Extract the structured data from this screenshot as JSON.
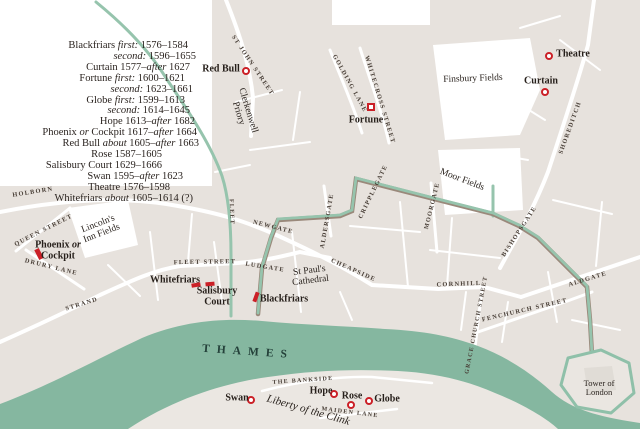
{
  "colors": {
    "building": "#e7e2dd",
    "south_bank": "#ebe7e2",
    "river_green": "#85b7a0",
    "wall_green": "#96c4ad",
    "wall_brown": "#9a897b",
    "marker_red": "#cb2027",
    "text_dark": "#2b2420"
  },
  "legend": {
    "lines": [
      {
        "pad": 12,
        "segments": [
          {
            "t": "Blackfriars "
          },
          {
            "t": "first:",
            "i": true
          },
          {
            "t": " 1576–1584"
          }
        ]
      },
      {
        "pad": 4,
        "segments": [
          {
            "t": "second:",
            "i": true
          },
          {
            "t": " 1596–1655"
          }
        ]
      },
      {
        "pad": 10,
        "segments": [
          {
            "t": "Curtain 1577–"
          },
          {
            "t": "after",
            "i": true
          },
          {
            "t": " 1627"
          }
        ]
      },
      {
        "pad": 15,
        "segments": [
          {
            "t": "Fortune "
          },
          {
            "t": "first:",
            "i": true
          },
          {
            "t": " 1600–1621"
          }
        ]
      },
      {
        "pad": 7,
        "segments": [
          {
            "t": "second:",
            "i": true
          },
          {
            "t": " 1623–1661"
          }
        ]
      },
      {
        "pad": 15,
        "segments": [
          {
            "t": "Globe "
          },
          {
            "t": "first:",
            "i": true
          },
          {
            "t": " 1599–1613"
          }
        ]
      },
      {
        "pad": 10,
        "segments": [
          {
            "t": "second:",
            "i": true
          },
          {
            "t": " 1614–1645"
          }
        ]
      },
      {
        "pad": 5,
        "segments": [
          {
            "t": "Hope 1613–"
          },
          {
            "t": "after",
            "i": true
          },
          {
            "t": " 1682"
          }
        ]
      },
      {
        "pad": 3,
        "segments": [
          {
            "t": "Phoenix "
          },
          {
            "t": "or",
            "i": true
          },
          {
            "t": " Cockpit 1617–"
          },
          {
            "t": "after",
            "i": true
          },
          {
            "t": " 1664"
          }
        ]
      },
      {
        "pad": 1,
        "segments": [
          {
            "t": "Red Bull "
          },
          {
            "t": "about",
            "i": true
          },
          {
            "t": " 1605–"
          },
          {
            "t": "after",
            "i": true
          },
          {
            "t": " 1663"
          }
        ]
      },
      {
        "pad": 38,
        "segments": [
          {
            "t": "Rose 1587–1605"
          }
        ]
      },
      {
        "pad": 38,
        "segments": [
          {
            "t": "Salisbury Court 1629–1666"
          }
        ]
      },
      {
        "pad": 17,
        "segments": [
          {
            "t": "Swan 1595–"
          },
          {
            "t": "after",
            "i": true
          },
          {
            "t": " 1623"
          }
        ]
      },
      {
        "pad": 30,
        "segments": [
          {
            "t": "Theatre 1576–1598"
          }
        ]
      },
      {
        "pad": 7,
        "segments": [
          {
            "t": "Whitefriars "
          },
          {
            "t": "about",
            "i": true
          },
          {
            "t": " 1605–1614 (?)"
          }
        ]
      }
    ]
  },
  "map": {
    "streets": [
      {
        "t": "HOLBORN",
        "x": 33,
        "y": 193,
        "r": -9
      },
      {
        "t": "QUEEN STREET",
        "x": 44,
        "y": 231,
        "r": -27
      },
      {
        "t": "DRURY LANE",
        "x": 51,
        "y": 268,
        "r": 14
      },
      {
        "t": "STRAND",
        "x": 82,
        "y": 305,
        "r": -17
      },
      {
        "t": "FLEET STREET",
        "x": 205,
        "y": 263,
        "r": -1
      },
      {
        "t": "LUDGATE",
        "x": 265,
        "y": 268,
        "r": 9
      },
      {
        "t": "NEWGATE",
        "x": 273,
        "y": 228,
        "r": 14
      },
      {
        "t": "CHEAPSIDE",
        "x": 353,
        "y": 271,
        "r": 24
      },
      {
        "t": "CORNHILL",
        "x": 459,
        "y": 285,
        "r": -2
      },
      {
        "t": "FENCHURCH STREET",
        "x": 525,
        "y": 311,
        "r": -13
      },
      {
        "t": "GRACE CHURCH STREET",
        "x": 477,
        "y": 325,
        "r": -79,
        "s": 6
      },
      {
        "t": "ALDGATE",
        "x": 588,
        "y": 280,
        "r": -17
      },
      {
        "t": "BISHOPSGATE",
        "x": 520,
        "y": 232,
        "r": -57
      },
      {
        "t": "MOORGATE",
        "x": 433,
        "y": 206,
        "r": -76
      },
      {
        "t": "CRIPPLEGATE",
        "x": 374,
        "y": 192,
        "r": -64
      },
      {
        "t": "ALDERSGATE",
        "x": 328,
        "y": 221,
        "r": -80
      },
      {
        "t": "ST JOHN STREET",
        "x": 252,
        "y": 66,
        "r": 56
      },
      {
        "t": "GOLDING LANE",
        "x": 349,
        "y": 84,
        "r": 61
      },
      {
        "t": "WHITECROSS STREET",
        "x": 379,
        "y": 100,
        "r": 73
      },
      {
        "t": "SHOREDITCH",
        "x": 571,
        "y": 128,
        "r": -70
      },
      {
        "t": "MAIDEN LANE",
        "x": 350,
        "y": 413,
        "r": 7,
        "s": 6
      },
      {
        "t": "THE BANKSIDE",
        "x": 303,
        "y": 381,
        "r": -4,
        "s": 6
      },
      {
        "t": "FLEET",
        "x": 231,
        "y": 212,
        "r": 88,
        "s": 6
      }
    ],
    "places": [
      {
        "lines": [
          "Clerkenwell",
          "Priory"
        ],
        "x": 243,
        "y": 112,
        "r": 73
      },
      {
        "lines": [
          "Finsbury Fields"
        ],
        "x": 473,
        "y": 79,
        "r": -2
      },
      {
        "lines": [
          "Moor Fields"
        ],
        "x": 462,
        "y": 180,
        "r": 21
      },
      {
        "lines": [
          "Lincoln's",
          "Inn Fields"
        ],
        "x": 100,
        "y": 229,
        "r": -21
      },
      {
        "lines": [
          "St Paul's",
          "Cathedral"
        ],
        "x": 310,
        "y": 276,
        "r": -7
      },
      {
        "lines": [
          "Liberty of the Clink"
        ],
        "x": 308,
        "y": 411,
        "r": 16,
        "italic": true,
        "s": 11
      },
      {
        "lines": [
          "Tower of",
          "London"
        ],
        "x": 599,
        "y": 388,
        "r": 0,
        "s": 8.5
      },
      {
        "lines": [
          "THAMES"
        ],
        "x": 248,
        "y": 352,
        "r": 4,
        "cls": "thames"
      }
    ],
    "theatres": [
      {
        "name": "Theatre",
        "marker": {
          "type": "circle",
          "x": 549,
          "y": 56
        },
        "label": {
          "x": 573,
          "y": 55,
          "lines": [
            [
              {
                "t": "Theatre"
              }
            ]
          ]
        }
      },
      {
        "name": "Curtain",
        "marker": {
          "type": "circle",
          "x": 545,
          "y": 92
        },
        "label": {
          "x": 541,
          "y": 82,
          "lines": [
            [
              {
                "t": "Curtain"
              }
            ]
          ]
        }
      },
      {
        "name": "Red Bull",
        "marker": {
          "type": "circle",
          "x": 246,
          "y": 71
        },
        "label": {
          "x": 221,
          "y": 70,
          "lines": [
            [
              {
                "t": "Red Bull"
              }
            ]
          ]
        }
      },
      {
        "name": "Fortune",
        "marker": {
          "type": "square",
          "x": 371,
          "y": 107
        },
        "label": {
          "x": 366,
          "y": 121,
          "lines": [
            [
              {
                "t": "Fortune"
              }
            ]
          ]
        }
      },
      {
        "name": "Phoenix or Cockpit",
        "marker": {
          "type": "rect",
          "x": 39,
          "y": 254,
          "w": 5,
          "h": 11,
          "r": -27
        },
        "label": {
          "x": 58,
          "y": 251,
          "lines": [
            [
              {
                "t": "Phoenix "
              },
              {
                "t": "or",
                "i": true
              }
            ],
            [
              {
                "t": "Cockpit"
              }
            ]
          ]
        }
      },
      {
        "name": "Whitefriars",
        "marker": {
          "type": "rect",
          "x": 196,
          "y": 285,
          "w": 9,
          "h": 4,
          "r": -10
        },
        "label": {
          "x": 175,
          "y": 281,
          "lines": [
            [
              {
                "t": "Whitefriars"
              }
            ]
          ]
        }
      },
      {
        "name": "Salisbury Court",
        "marker": {
          "type": "rect",
          "x": 210,
          "y": 284,
          "w": 9,
          "h": 4,
          "r": -5
        },
        "label": {
          "x": 217,
          "y": 297,
          "lines": [
            [
              {
                "t": "Salisbury"
              }
            ],
            [
              {
                "t": "Court"
              }
            ]
          ]
        }
      },
      {
        "name": "Blackfriars",
        "marker": {
          "type": "rect",
          "x": 256,
          "y": 297,
          "w": 4,
          "h": 10,
          "r": 20
        },
        "label": {
          "x": 284,
          "y": 300,
          "lines": [
            [
              {
                "t": "Blackfriars"
              }
            ]
          ]
        }
      },
      {
        "name": "Swan",
        "marker": {
          "type": "circle",
          "x": 251,
          "y": 400
        },
        "label": {
          "x": 237,
          "y": 399,
          "lines": [
            [
              {
                "t": "Swan"
              }
            ]
          ]
        }
      },
      {
        "name": "Hope",
        "marker": {
          "type": "circle",
          "x": 334,
          "y": 394
        },
        "label": {
          "x": 321,
          "y": 392,
          "lines": [
            [
              {
                "t": "Hope"
              }
            ]
          ]
        }
      },
      {
        "name": "Rose",
        "marker": {
          "type": "circle",
          "x": 351,
          "y": 405
        },
        "label": {
          "x": 352,
          "y": 397,
          "lines": [
            [
              {
                "t": "Rose"
              }
            ]
          ]
        }
      },
      {
        "name": "Globe",
        "marker": {
          "type": "circle",
          "x": 369,
          "y": 401
        },
        "label": {
          "x": 387,
          "y": 400,
          "lines": [
            [
              {
                "t": "Globe"
              }
            ]
          ]
        }
      }
    ]
  }
}
